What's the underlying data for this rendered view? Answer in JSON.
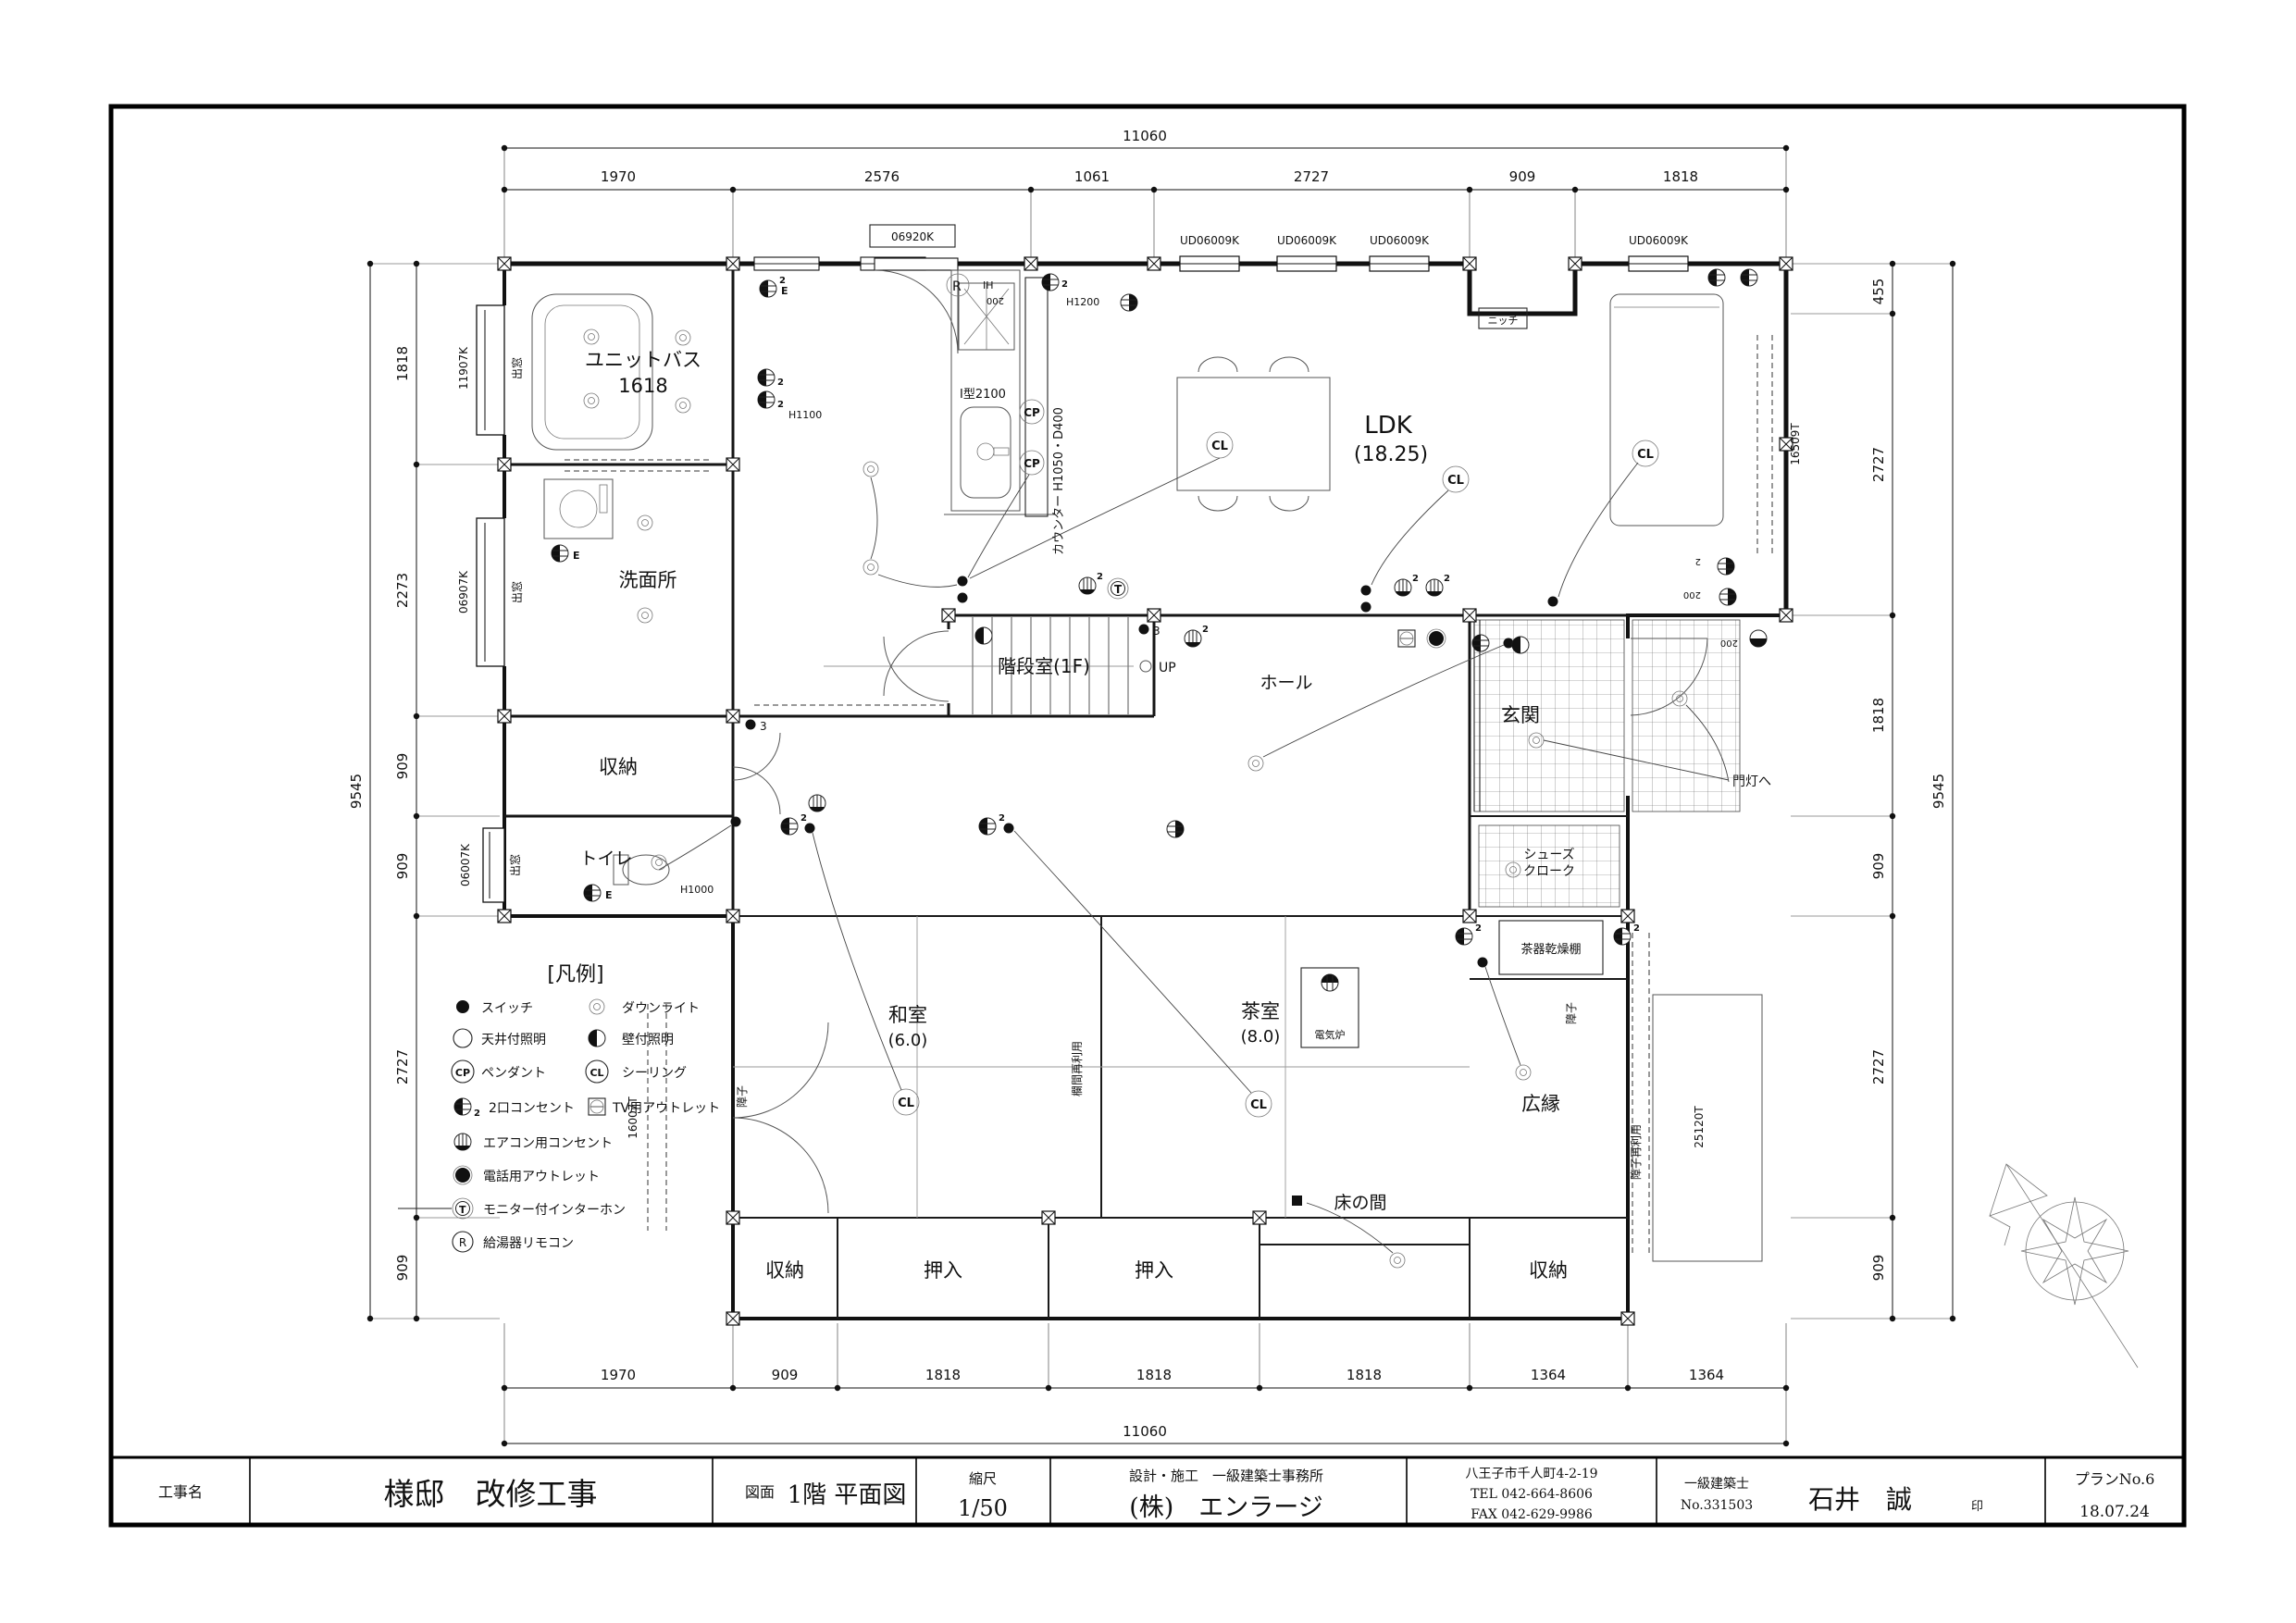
{
  "title_block": {
    "label_koji": "工事名",
    "owner": "様邸　改修工事",
    "zumen_label": "図面",
    "zumen": "1階 平面図",
    "scale_label": "縮尺",
    "scale": "1/50",
    "design_label": "設計・施工　一級建築士事務所",
    "company": "(株)　エンラージ",
    "address": "八王子市千人町4-2-19",
    "tel": "TEL 042-664-8606",
    "fax": "FAX 042-629-9986",
    "arch_title": "一級建築士",
    "arch_no": "No.331503",
    "arch_name": "石井　誠",
    "seal": "印",
    "plan_no": "プランNo.6",
    "date": "18.07.24"
  },
  "rooms": {
    "bath": "ユニットバス",
    "bath_size": "1618",
    "wash": "洗面所",
    "shuno": "収納",
    "toilet": "トイレ",
    "stair": "階段室(1F)",
    "up": "UP",
    "ldk": "LDK",
    "ldk_size": "(18.25)",
    "hall": "ホール",
    "genkan": "玄関",
    "shoes1": "シューズ",
    "shoes2": "クローク",
    "washitsu": "和室",
    "washitsu_size": "(6.0)",
    "chashitsu": "茶室",
    "chashitsu_size": "(8.0)",
    "denkiro": "電気炉",
    "tokonoma": "床の間",
    "oshiire": "押入",
    "hiroen": "広縁",
    "chaki": "茶器乾燥棚"
  },
  "labels": {
    "demado": "出窓",
    "niche": "ニッチ",
    "kitchen": "I型2100",
    "counter": "カウンター H1050・D400",
    "h1100": "H1100",
    "h1200": "H1200",
    "h1000": "H1000",
    "v200": "200",
    "two": "2",
    "three": "3",
    "montou": "門灯へ",
    "ranma": "欄間再利用",
    "shoji": "障子",
    "shoji_reuse": "障子再利用",
    "win_l1": "11907K",
    "win_l2": "06907K",
    "win_l3": "06007K",
    "door_top": "06920K",
    "win_ud": "UD06009K",
    "win_r1": "16509T",
    "win_r2": "25120T",
    "win_wa": "16007T",
    "cl": "CL",
    "cp": "CP",
    "r": "R",
    "ih": "IH",
    "t": "T",
    "e": "E"
  },
  "legend": {
    "title": "[凡例]",
    "items": [
      {
        "icon": "switch-icon",
        "label": "スイッチ"
      },
      {
        "icon": "downlight-icon",
        "label": "ダウンライト"
      },
      {
        "icon": "ceiling-light-icon",
        "label": "天井付照明"
      },
      {
        "icon": "wall-light-icon",
        "label": "壁付照明"
      },
      {
        "icon": "pendant-icon",
        "label": "ペンダント"
      },
      {
        "icon": "ceiling-cl-icon",
        "label": "シーリング"
      },
      {
        "icon": "outlet2-icon",
        "label": "2口コンセント"
      },
      {
        "icon": "tv-outlet-icon",
        "label": "TV用アウトレット"
      },
      {
        "icon": "aircon-outlet-icon",
        "label": "エアコン用コンセント"
      },
      {
        "icon": "phone-outlet-icon",
        "label": "電話用アウトレット"
      },
      {
        "icon": "intercom-icon",
        "label": "モニター付インターホン"
      },
      {
        "icon": "remote-icon",
        "label": "給湯器リモコン"
      }
    ]
  },
  "dims": {
    "top_total": "11060",
    "top": [
      "1970",
      "2576",
      "1061",
      "2727",
      "909",
      "1818"
    ],
    "bottom": [
      "1970",
      "909",
      "1818",
      "1818",
      "1818",
      "1364",
      "1364"
    ],
    "bottom_total": "11060",
    "left": [
      "1818",
      "2273",
      "909",
      "909",
      "2727",
      "909"
    ],
    "left_total": "9545",
    "right": [
      "455",
      "2727",
      "1818",
      "909",
      "2727",
      "909"
    ],
    "right_total": "9545"
  }
}
